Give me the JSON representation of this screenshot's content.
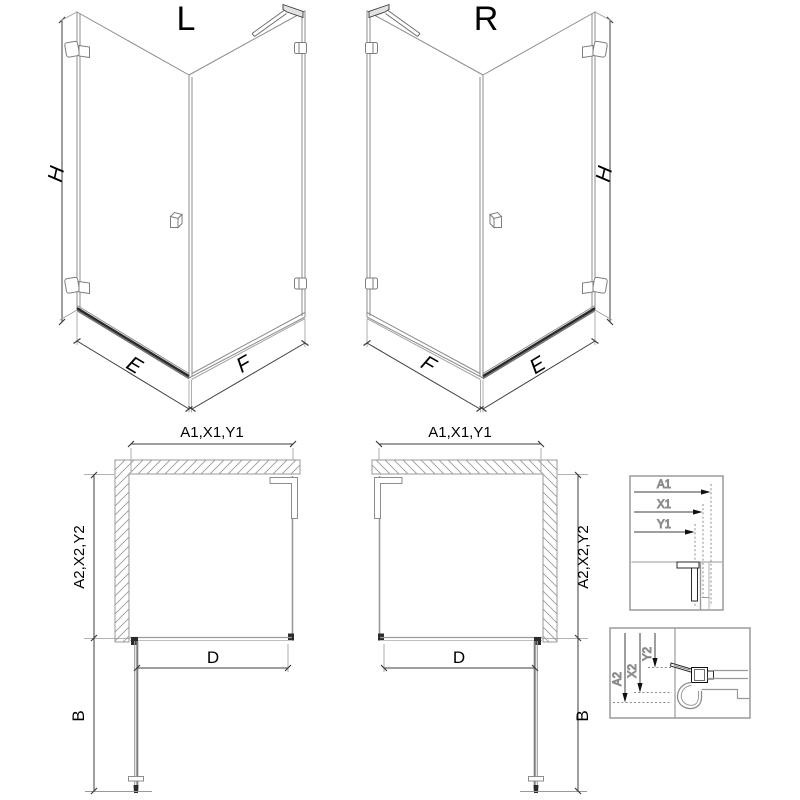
{
  "iso_left": {
    "label": "L",
    "dim_height": "H",
    "dim_door_width": "E",
    "dim_side_width": "F"
  },
  "iso_right": {
    "label": "R",
    "dim_height": "H",
    "dim_door_width": "E",
    "dim_side_width": "F"
  },
  "plan_left": {
    "dim_top": "A1,X1,Y1",
    "dim_side": "A2,X2,Y2",
    "dim_door_open": "B",
    "dim_inner_width": "D"
  },
  "plan_right": {
    "dim_top": "A1,X1,Y1",
    "dim_side": "A2,X2,Y2",
    "dim_door_open": "B",
    "dim_inner_width": "D"
  },
  "detail_horizontal": {
    "dims": [
      "A1",
      "X1",
      "Y1"
    ]
  },
  "detail_vertical": {
    "dims": [
      "A2",
      "X2",
      "Y2"
    ]
  },
  "colors": {
    "background": "#ffffff",
    "line_gray": "#8c8c8c",
    "line_light": "#b4b4b4",
    "line_dark": "#2b2b2b",
    "dim_line": "#3c3c3c",
    "text": "#000000"
  }
}
